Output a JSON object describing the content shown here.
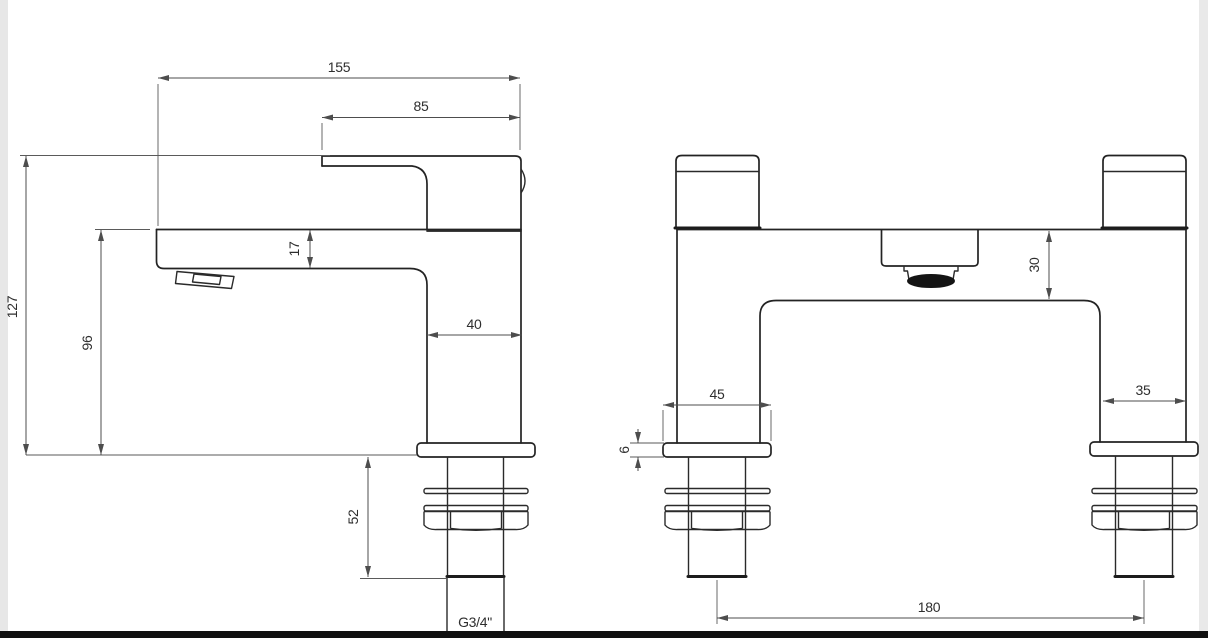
{
  "page": {
    "background": "#ffffff",
    "left_strip_color": "#e7e7e7",
    "right_strip_color": "#e9e9e9",
    "bottom_bar_color": "#101010",
    "object_line_color": "#232323",
    "dimension_line_color": "#4d4d4d"
  },
  "drawing": {
    "type": "technical-drawing",
    "subject": "Bath filler mixer tap - dimensioned side and front elevations",
    "units": "mm",
    "views": [
      {
        "id": "side",
        "description": "Side elevation of tap with lever handle, spout and threaded shank"
      },
      {
        "id": "front",
        "description": "Front elevation of twin-pillar bath filler with centre spout"
      }
    ]
  },
  "dims": {
    "side": {
      "overall_depth": "155",
      "handle_reach": "85",
      "overall_height": "127",
      "spout_clearance": "96",
      "spout_section": "17",
      "body_width": "40",
      "shank_length": "52",
      "thread_size": "G3/4\""
    },
    "front": {
      "flange_width": "45",
      "flange_height": "6",
      "spout_drop": "30",
      "pillar_width": "35",
      "tap_centres": "180"
    }
  }
}
